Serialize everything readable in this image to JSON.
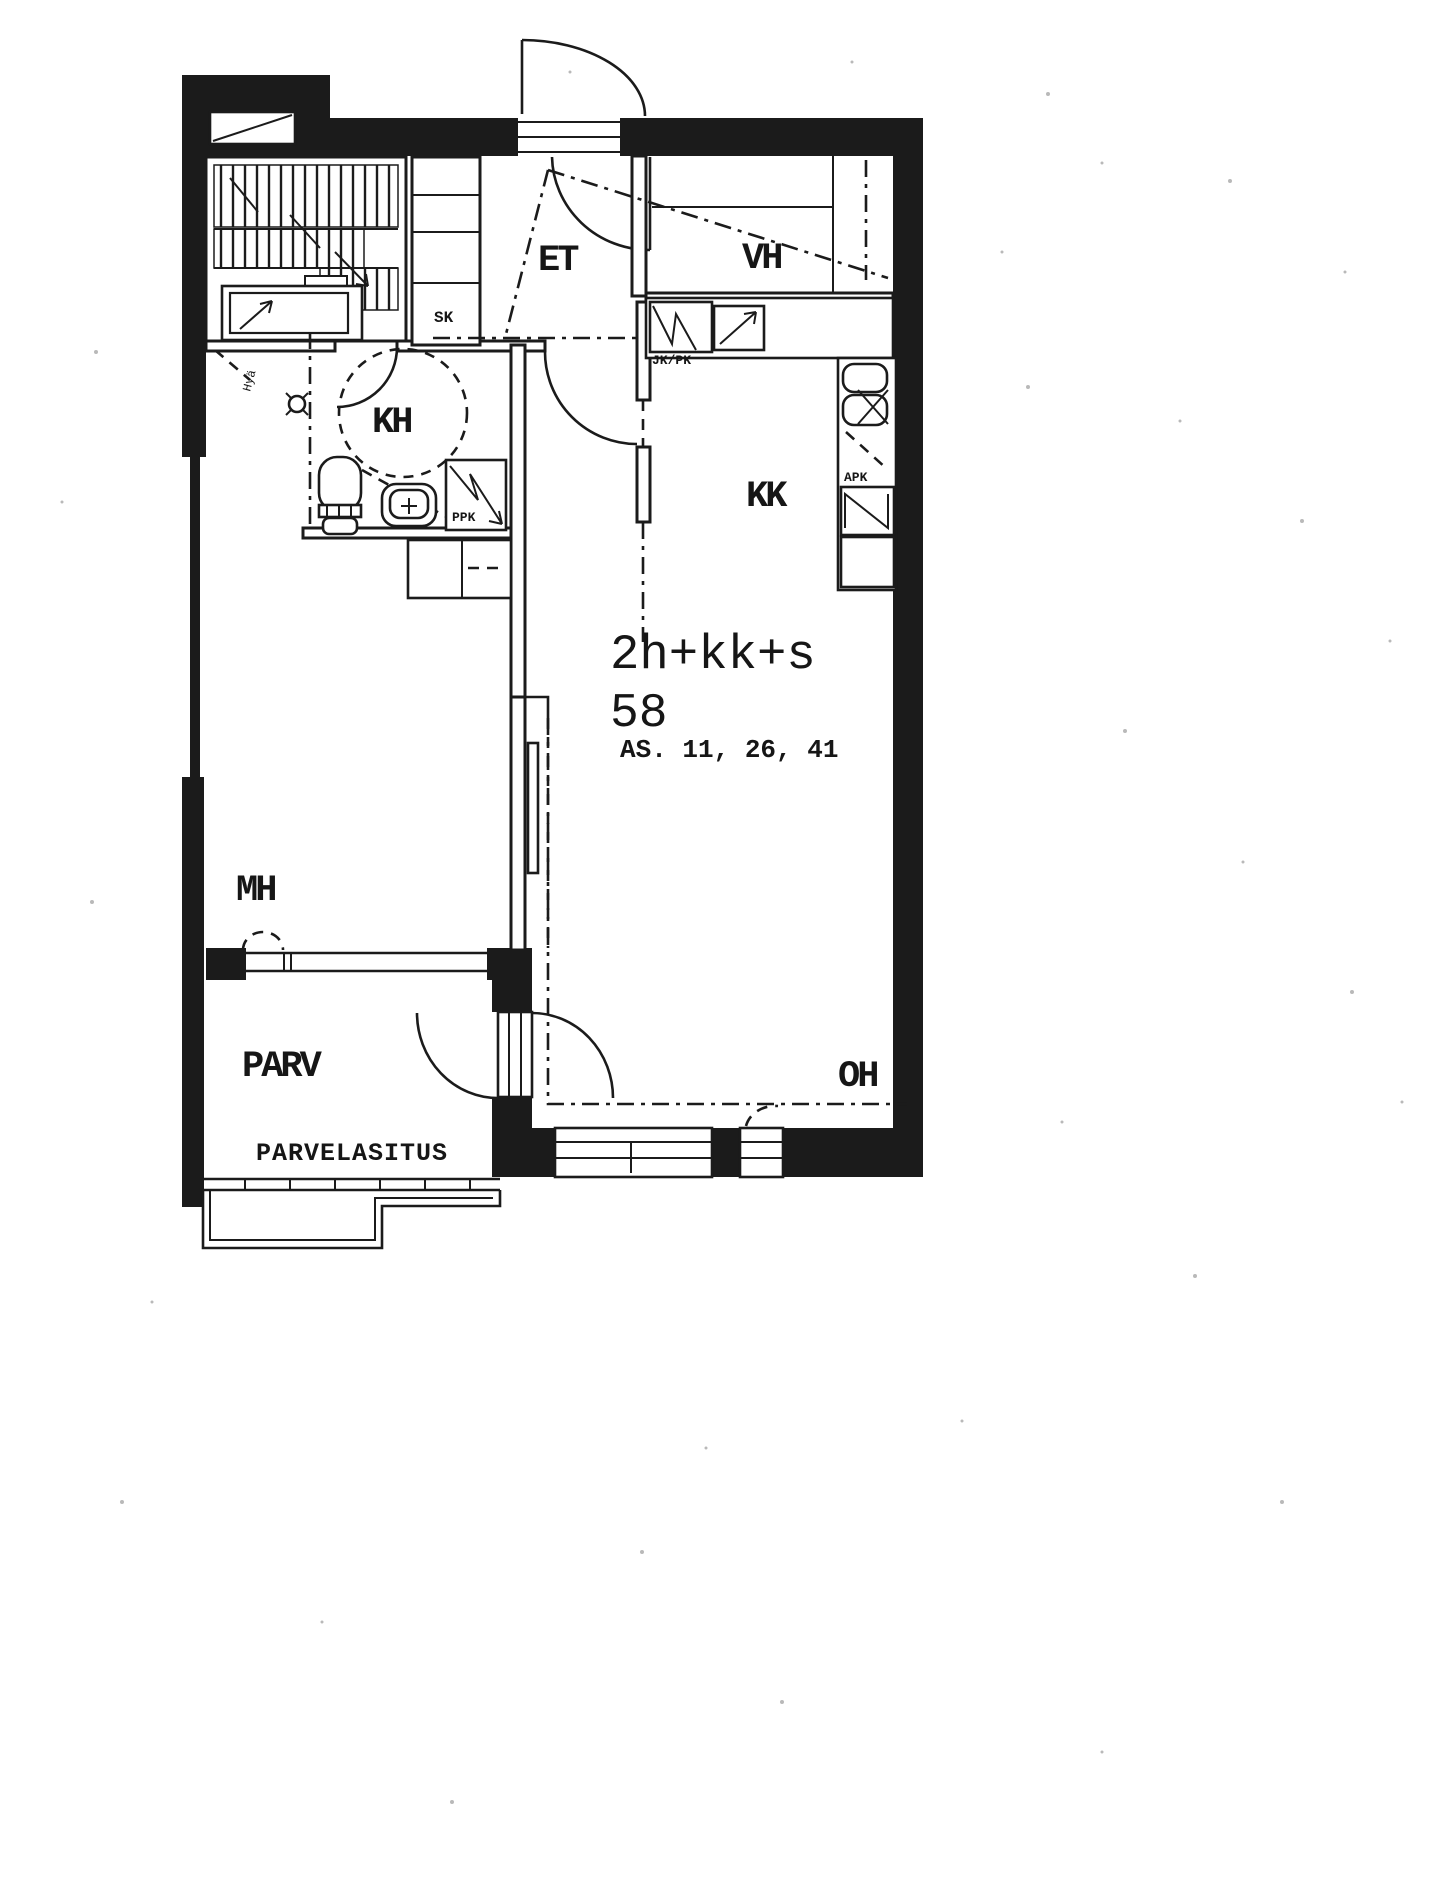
{
  "scan": {
    "paper_color": "#ffffff",
    "ink_color": "#1b1b1b"
  },
  "plan": {
    "unit_type": "2h+kk+s",
    "area_m2": "58",
    "apartment_numbers": "AS. 11, 26, 41",
    "rooms": [
      {
        "id": "et",
        "label": "ET"
      },
      {
        "id": "vh",
        "label": "VH"
      },
      {
        "id": "kh",
        "label": "KH"
      },
      {
        "id": "kk",
        "label": "KK"
      },
      {
        "id": "mh",
        "label": "MH"
      },
      {
        "id": "oh",
        "label": "OH"
      },
      {
        "id": "parv",
        "label": "PARV"
      }
    ],
    "annotations": {
      "sk": "SK",
      "jk_pk": "JK/PK",
      "apk": "APK",
      "ppk": "PPK",
      "parvelasitus": "PARVELASITUS",
      "hand_note": "Hyä"
    }
  }
}
